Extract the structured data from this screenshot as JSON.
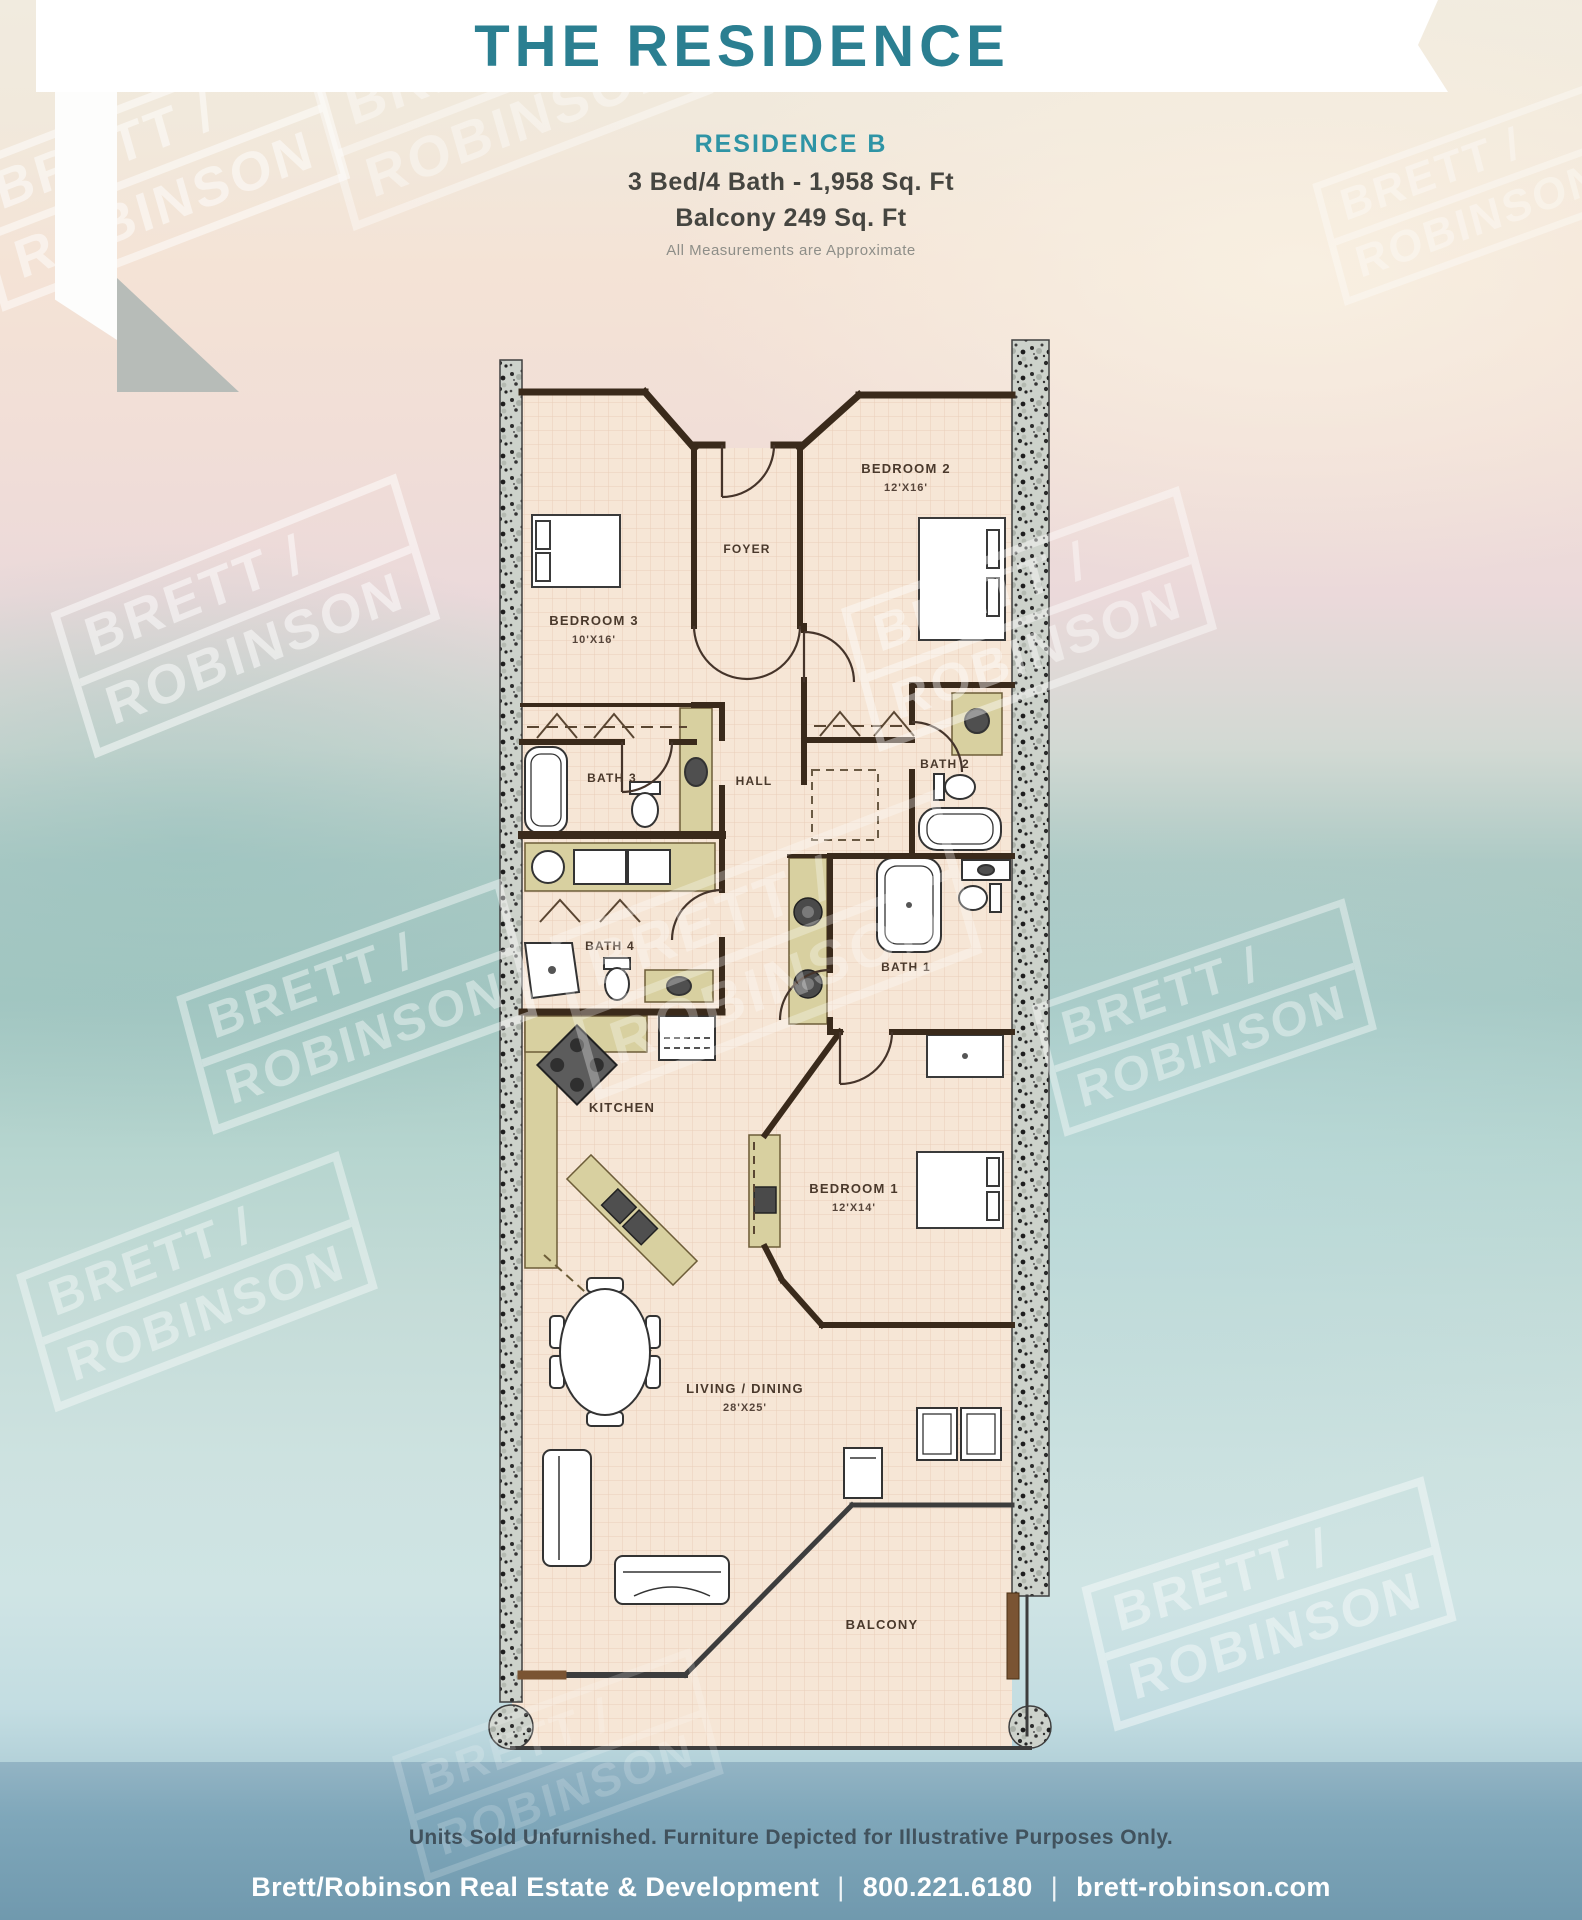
{
  "header": {
    "title": "THE RESIDENCE"
  },
  "subtitle": {
    "name": "RESIDENCE B",
    "specs": "3 Bed/4 Bath - 1,958 Sq. Ft",
    "balcony": "Balcony 249 Sq. Ft",
    "note": "All Measurements are Approximate"
  },
  "plan": {
    "rooms": [
      {
        "name": "BEDROOM 2",
        "dims": "12'X16'"
      },
      {
        "name": "BEDROOM 3",
        "dims": "10'X16'"
      },
      {
        "name": "FOYER",
        "dims": ""
      },
      {
        "name": "BATH 3",
        "dims": ""
      },
      {
        "name": "HALL",
        "dims": ""
      },
      {
        "name": "BATH 2",
        "dims": ""
      },
      {
        "name": "BATH 4",
        "dims": ""
      },
      {
        "name": "BATH 1",
        "dims": ""
      },
      {
        "name": "KITCHEN",
        "dims": ""
      },
      {
        "name": "BEDROOM 1",
        "dims": "12'X14'"
      },
      {
        "name": "LIVING / DINING",
        "dims": "28'X25'"
      },
      {
        "name": "BALCONY",
        "dims": ""
      }
    ]
  },
  "watermark": {
    "line1": "BRETT /",
    "line2": "ROBINSON"
  },
  "disclaimer": "Units Sold Unfurnished. Furniture Depicted for Illustrative Purposes Only.",
  "footer": {
    "company": "Brett/Robinson Real Estate & Development",
    "phone": "800.221.6180",
    "website": "brett-robinson.com",
    "separator": "|"
  },
  "colors": {
    "title_teal": "#2b7f91",
    "subtitle_teal": "#2e94a5",
    "wall_brown": "#3a2a1b",
    "floor": "#f6e6d6",
    "cabinet": "#d8d0a0",
    "concrete": "#cdd2cb",
    "band_blue": "#7fa7ba"
  }
}
